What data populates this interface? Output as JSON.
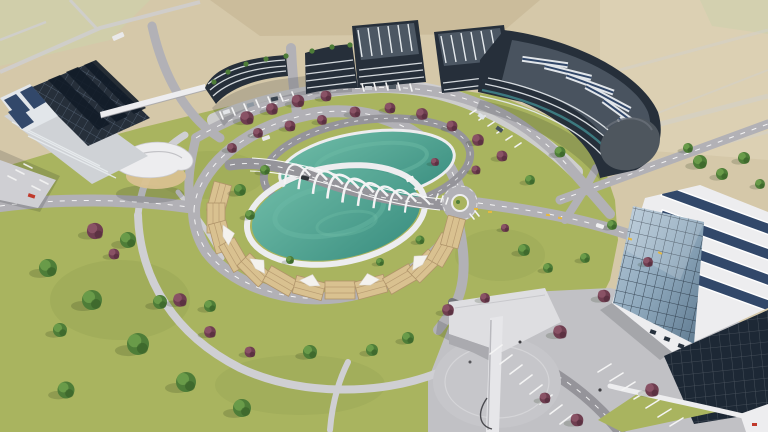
{
  "scene": {
    "type": "aerial-3d-architectural-rendering",
    "description": "Aerial 3D architectural rendering of a modern technology campus: curved dark office buildings with rooftop solar panels and roof gardens, two oval green lakes joined by a white arched gateway bridge, a ring of tan pergola decks around the lower lake, a circular road with a small roundabout, lawns dotted with green and purple trees, a white shell canopy pavilion, a faceted glass building with solar roof in the foreground, parking lots, and beige farmland in the background.",
    "time_of_day": "daytime",
    "elements": {
      "buildings": [
        "solar-office-building-left",
        "curved-office-building-west",
        "curved-office-building-east",
        "glass-atrium-building",
        "entrance-pavilion-with-mast",
        "shell-canopy-pavilion"
      ],
      "landscape": [
        "farmland",
        "campus-lawn",
        "upper-lake",
        "lower-lake",
        "pergola-deck-ring",
        "promenade-path",
        "green-trees",
        "purple-trees"
      ],
      "infrastructure": [
        "ring-road",
        "front-road",
        "west-road",
        "north-road",
        "bridge-road",
        "east-road",
        "perimeter-road",
        "roundabout",
        "arch-bridge",
        "parking-lots",
        "skybridge"
      ]
    }
  },
  "palette": {
    "field": "#d5c8a9",
    "fieldLight": "#ded3b8",
    "fieldDark": "#c3b28f",
    "sage": "#cdd0ab",
    "lawn": "#a9b45f",
    "lawnShade": "#85974a",
    "road": "#b2b1b6",
    "roadDark": "#95949a",
    "path": "#cfcfd3",
    "plaza": "#c1c1c5",
    "white": "#ededef",
    "facadeDark": "#262f3a",
    "roofMid": "#4c5763",
    "solar": "#32486a",
    "solarLight": "#e2e6ea",
    "glass": "#8fa9bd",
    "glassDark": "#1d2835",
    "teal": "#3f8287",
    "water": "#3a8e80",
    "waterLight": "#6fbca7",
    "tan": "#d9c190",
    "tanDark": "#b0946a",
    "treeGreen": "#4e7d38",
    "treeLight": "#6fa04c",
    "treeDark": "#39622a",
    "treePurple": "#6f3e50",
    "purpleLight": "#8e5668",
    "purpleDark": "#552e3d",
    "yellow": "#e6b93f",
    "red": "#c0392b"
  }
}
